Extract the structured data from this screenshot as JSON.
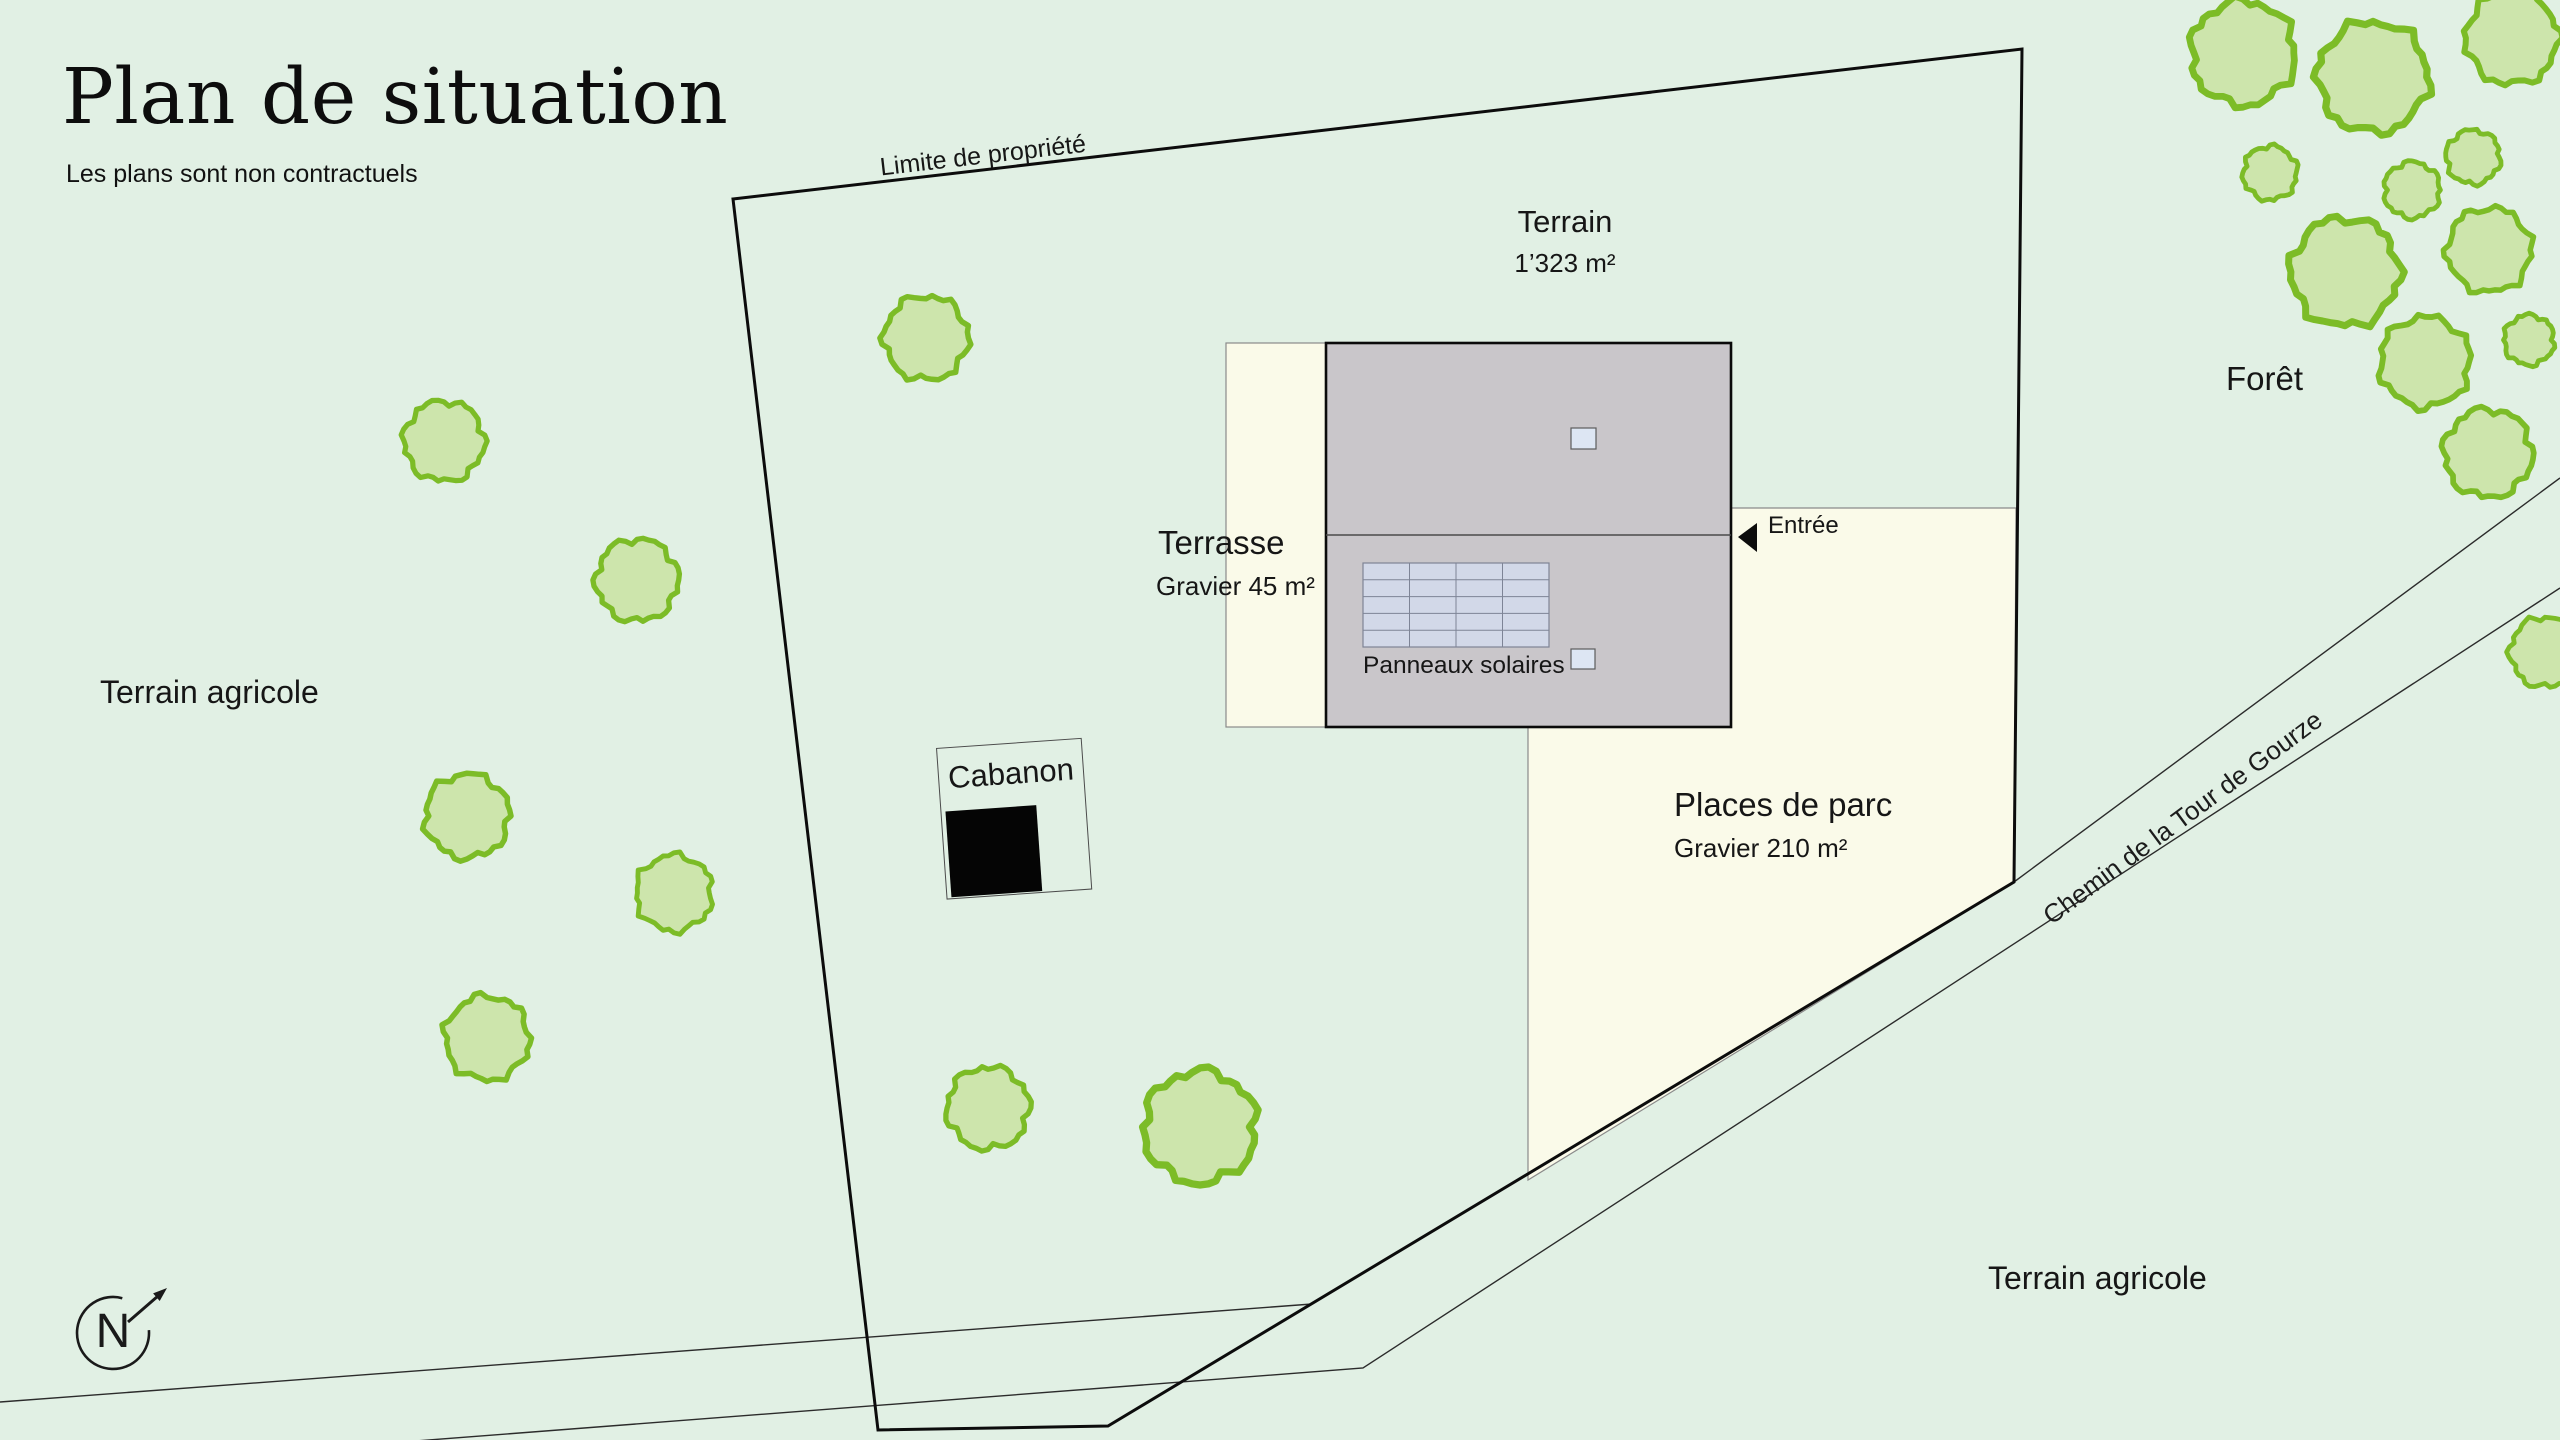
{
  "header": {
    "title": "Plan de situation",
    "subtitle": "Les plans sont non contractuels"
  },
  "boundary": {
    "label": "Limite de propriété"
  },
  "areas": {
    "terrain": {
      "name": "Terrain",
      "size": "1’323 m²"
    },
    "terrasse": {
      "name": "Terrasse",
      "size": "Gravier 45 m²"
    },
    "parking": {
      "name": "Places de parc",
      "size": "Gravier 210 m²"
    },
    "cabanon": {
      "name": "Cabanon"
    },
    "solar": {
      "name": "Panneaux solaires"
    },
    "entrance": {
      "name": "Entrée"
    }
  },
  "surroundings": {
    "forest": "Forêt",
    "agricultural_left": "Terrain agricole",
    "agricultural_bottom": "Terrain agricole",
    "road_name": "Chemin de la Tour de Gourze"
  },
  "compass": {
    "label": "N"
  },
  "colors": {
    "background": "#e1f0e4",
    "gravel_cream": "#fafae9",
    "building_gray": "#c9c6ca",
    "panel_fill": "#d2d8e8",
    "panel_grid": "#7e8496",
    "skylight_fill": "#dde6f3",
    "tree_fill": "#cde5ac",
    "tree_stroke": "#7cbc27",
    "boundary_black": "#0c0c0c",
    "thin_line": "#2b2b2b"
  },
  "map": {
    "trees": [
      [
        444,
        441,
        40
      ],
      [
        637,
        580,
        41
      ],
      [
        467,
        816,
        42
      ],
      [
        674,
        893,
        38
      ],
      [
        487,
        1038,
        42
      ],
      [
        926,
        338,
        42
      ],
      [
        988,
        1108,
        41
      ],
      [
        1200,
        1127,
        56
      ],
      [
        2243,
        53,
        52
      ],
      [
        2373,
        77,
        55
      ],
      [
        2512,
        38,
        46
      ],
      [
        2270,
        173,
        27
      ],
      [
        2412,
        190,
        28
      ],
      [
        2473,
        157,
        27
      ],
      [
        2345,
        272,
        54
      ],
      [
        2489,
        250,
        42
      ],
      [
        2425,
        362,
        45
      ],
      [
        2529,
        340,
        25
      ],
      [
        2488,
        453,
        44
      ],
      [
        2545,
        652,
        35
      ]
    ]
  }
}
